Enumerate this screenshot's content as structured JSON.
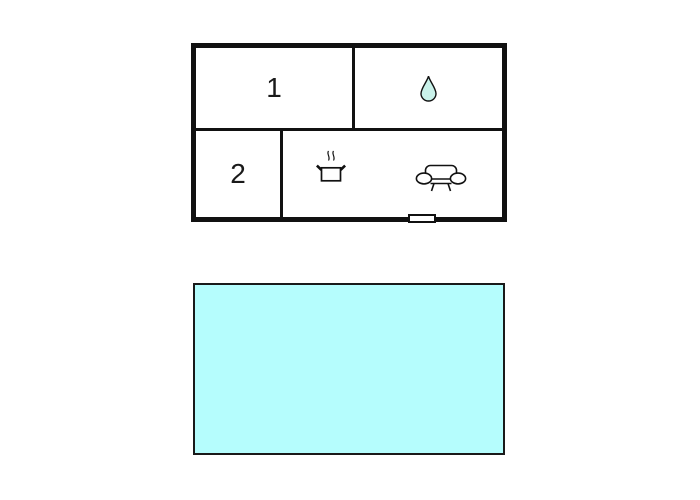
{
  "page": {
    "background": "#ffffff",
    "wall_color": "#111111"
  },
  "floor_plan": {
    "rooms": {
      "room1": {
        "label": "1"
      },
      "room2": {
        "label": "2"
      },
      "bathroom": {
        "icon": "water-drop-icon",
        "drop_fill": "#c9f2ea",
        "drop_stroke": "#111111"
      },
      "living_kitchen": {
        "icons": [
          "cooking-pot-icon",
          "sofa-icon"
        ],
        "icon_stroke": "#111111"
      }
    },
    "door_marker": {
      "fill": "#ffffff"
    }
  },
  "pool": {
    "fill": "#b5fdfd",
    "border_color": "#1a1a1a"
  }
}
